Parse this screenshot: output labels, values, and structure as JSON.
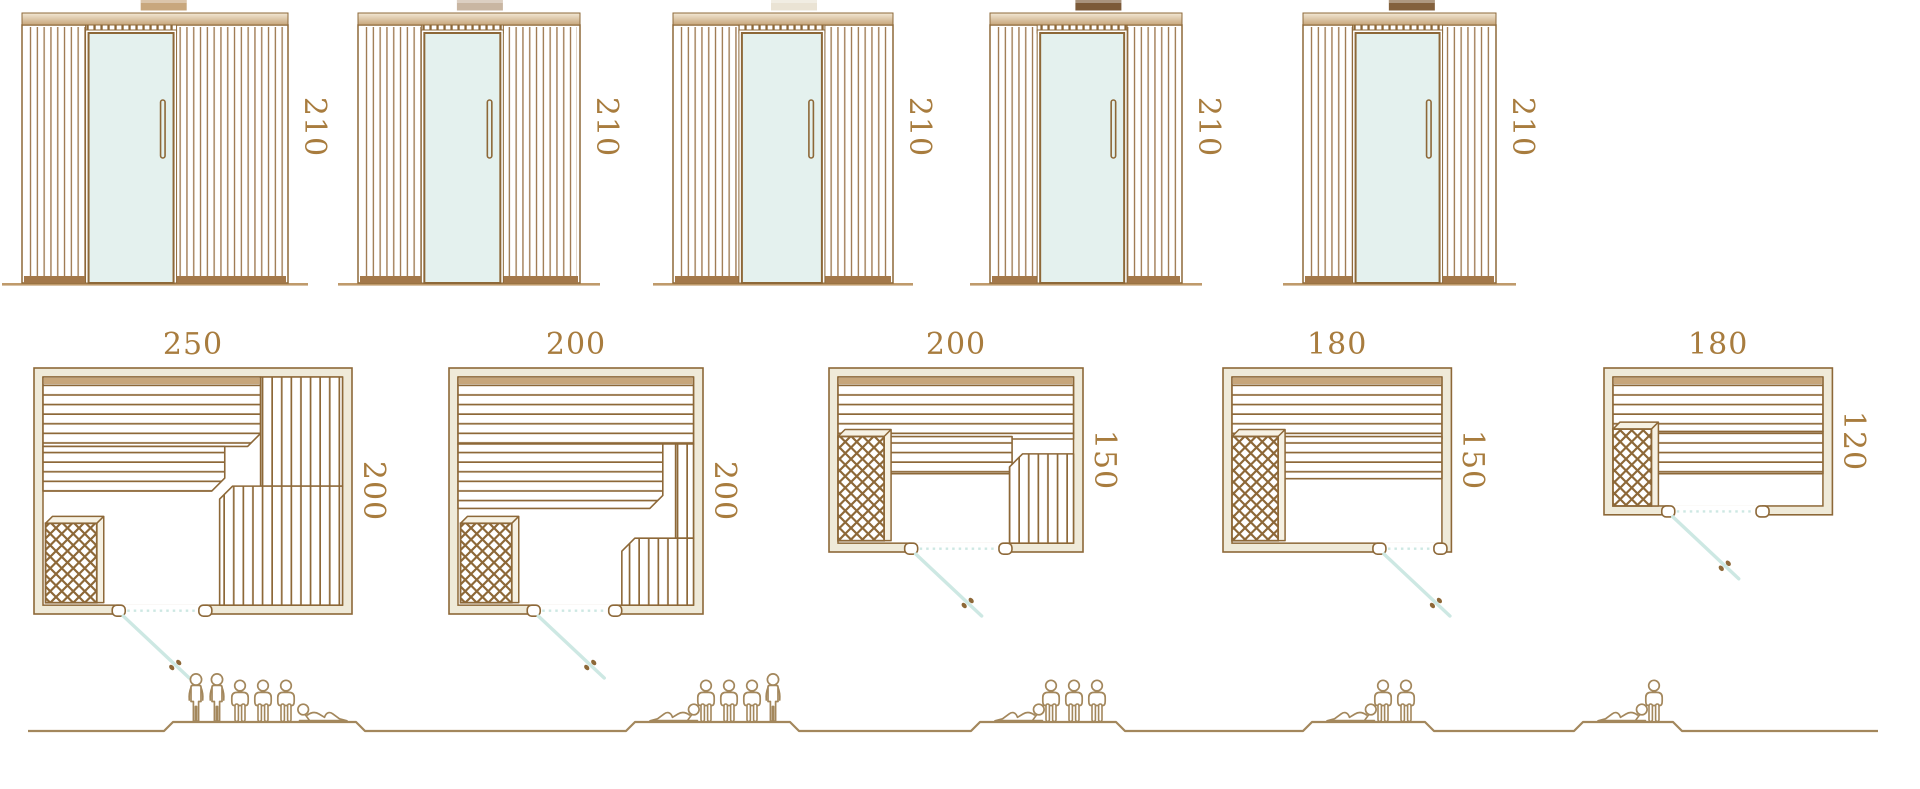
{
  "diagram": {
    "kind": "sauna-cabin-size-chart",
    "rows": [
      "front-elevations",
      "floor-plans",
      "seating-capacity"
    ]
  },
  "colors": {
    "outline_brown": "#8d6838",
    "label_brown": "#a87c3e",
    "wall_fill_cream": "#efead9",
    "bench_band_tan": "#c7a67b",
    "glass_mint": "#e4f1ee",
    "door_swing_cyan": "#cde8e3",
    "figure_brown": "#a3875c",
    "panel_base_brown": "#a3784a",
    "floor_line_tan": "#bf9a6b"
  },
  "models": [
    {
      "name": "sauna-250x200",
      "front_height_label": "210",
      "plan_width_label": "250",
      "plan_depth_label": "200",
      "plan_width_cm": 250,
      "plan_depth_cm": 200,
      "height_cm": 210,
      "swatch_color": "#c8a77d",
      "capacity_total": 6,
      "capacity_arrangement": [
        "standing-person",
        "standing-person",
        "sitting-person",
        "sitting-person",
        "sitting-person",
        "lying-person-flipped"
      ]
    },
    {
      "name": "sauna-200x200",
      "front_height_label": "210",
      "plan_width_label": "200",
      "plan_depth_label": "200",
      "plan_width_cm": 200,
      "plan_depth_cm": 200,
      "height_cm": 210,
      "swatch_color": "#c9b6a2",
      "capacity_total": 5,
      "capacity_arrangement": [
        "lying-person",
        "sitting-person",
        "sitting-person",
        "sitting-person",
        "standing-person"
      ]
    },
    {
      "name": "sauna-200x150",
      "front_height_label": "210",
      "plan_width_label": "200",
      "plan_depth_label": "150",
      "plan_width_cm": 200,
      "plan_depth_cm": 150,
      "height_cm": 210,
      "swatch_color": "#eae3d4",
      "capacity_total": 4,
      "capacity_arrangement": [
        "lying-person",
        "sitting-person",
        "sitting-person",
        "sitting-person"
      ]
    },
    {
      "name": "sauna-180x150",
      "front_height_label": "210",
      "plan_width_label": "180",
      "plan_depth_label": "150",
      "plan_width_cm": 180,
      "plan_depth_cm": 150,
      "height_cm": 210,
      "swatch_color": "#7c5a38",
      "capacity_total": 3,
      "capacity_arrangement": [
        "lying-person",
        "sitting-person",
        "sitting-person"
      ]
    },
    {
      "name": "sauna-180x120",
      "front_height_label": "210",
      "plan_width_label": "180",
      "plan_depth_label": "120",
      "plan_width_cm": 180,
      "plan_depth_cm": 120,
      "height_cm": 210,
      "swatch_color": "#83613d",
      "capacity_total": 2,
      "capacity_arrangement": [
        "lying-person",
        "sitting-person"
      ]
    }
  ]
}
